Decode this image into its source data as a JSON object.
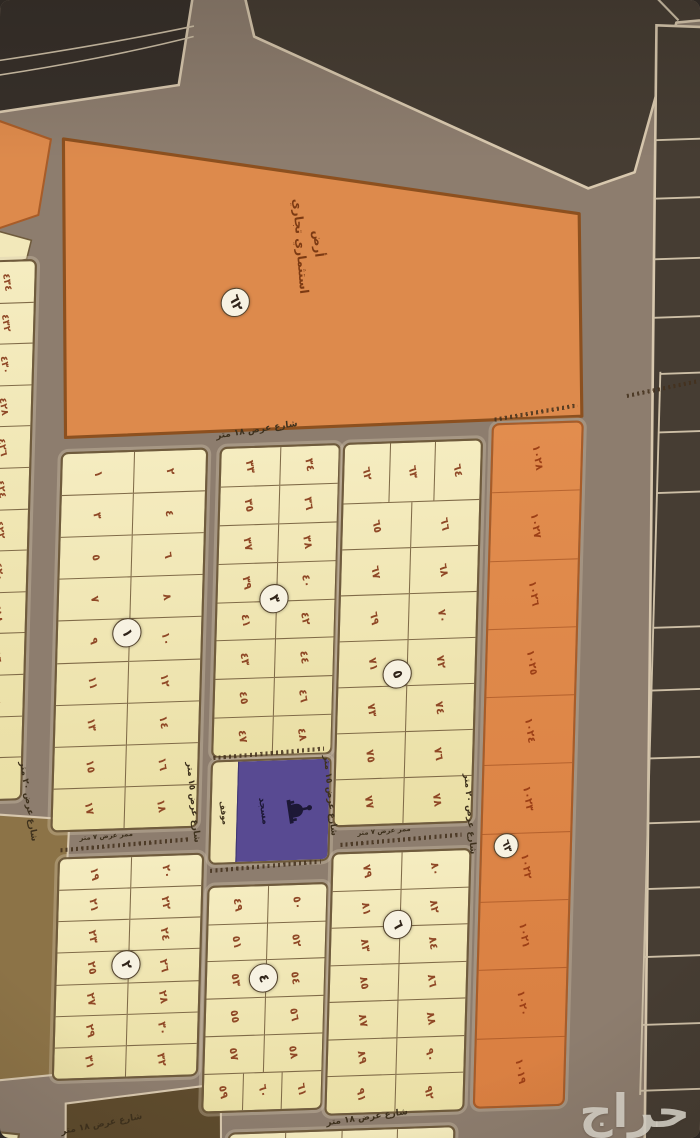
{
  "watermark": "حراج",
  "commercial": {
    "name_line1": "أرض",
    "name_line2": "استثماري تجاري",
    "circle": "٦٢"
  },
  "orange_strip": {
    "circle": "٦٣",
    "plots": [
      "١٠٢٨",
      "١٠٢٧",
      "١٠٢٦",
      "١٠٢٥",
      "١٠٢٤",
      "١٠٢٣",
      "١٠٢٢",
      "١٠٢١",
      "١٠٢٠",
      "١٠١٩"
    ]
  },
  "left_column": [
    "٤٣٤",
    "٤٣٢",
    "٤٣٠",
    "٤٢٨",
    "٤٢٦",
    "٤٢٤",
    "٤٢٢",
    "٤٢٠",
    "٤١٨",
    "٤١٦",
    "٤١٤",
    "٤١٢",
    "٤١٠"
  ],
  "blocks": {
    "b1": {
      "circle": "١",
      "left": [
        "١",
        "٣",
        "٥",
        "٧",
        "٩",
        "١١",
        "١٣",
        "١٥",
        "١٧"
      ],
      "right": [
        "٢",
        "٤",
        "٦",
        "٨",
        "١٠",
        "١٢",
        "١٤",
        "١٦",
        "١٨"
      ]
    },
    "b2": {
      "circle": "٢",
      "left": [
        "١٩",
        "٢١",
        "٢٣",
        "٢٥",
        "٢٧",
        "٢٩",
        "٣١"
      ],
      "right": [
        "٢٠",
        "٢٢",
        "٢٤",
        "٢٦",
        "٢٨",
        "٣٠",
        "٣٢"
      ]
    },
    "b3": {
      "circle": "٣",
      "left": [
        "٣٣",
        "٣٥",
        "٣٧",
        "٣٩",
        "٤١",
        "٤٣",
        "٤٥",
        "٤٧"
      ],
      "right": [
        "٣٤",
        "٣٦",
        "٣٨",
        "٤٠",
        "٤٢",
        "٤٤",
        "٤٦",
        "٤٨"
      ]
    },
    "b4": {
      "circle": "٤",
      "left": [
        "٤٩",
        "٥١",
        "٥٣",
        "٥٥",
        "٥٧"
      ],
      "right": [
        "٥٠",
        "٥٢",
        "٥٤",
        "٥٦",
        "٥٨"
      ],
      "bottom": [
        "٥٩",
        "٦٠",
        "٦١"
      ]
    },
    "b5": {
      "circle": "٥",
      "top": [
        "٦٢",
        "٦٣",
        "٦٤"
      ],
      "left": [
        "٦٥",
        "٦٧",
        "٦٩",
        "٧١",
        "٧٣",
        "٧٥",
        "٧٧"
      ],
      "right": [
        "٦٦",
        "٦٨",
        "٧٠",
        "٧٢",
        "٧٤",
        "٧٦",
        "٧٨"
      ]
    },
    "b6": {
      "circle": "٦",
      "left": [
        "٧٩",
        "٨١",
        "٨٣",
        "٨٥",
        "٨٧",
        "٨٩",
        "٩١"
      ],
      "right": [
        "٨٠",
        "٨٢",
        "٨٤",
        "٨٦",
        "٨٨",
        "٩٠",
        "٩٢"
      ]
    }
  },
  "bottom_row": [
    "٩٣",
    "٩٥",
    "٩٧",
    "٩٩"
  ],
  "mosque": {
    "label": "مسجد",
    "parking": "موقف"
  },
  "streets": {
    "s18_top": "شارع عرض ١٨ متر",
    "s20_left": "شارع عرض ٢٠ متر",
    "s15_left": "شارع عرض ١٥ متر",
    "s15_right": "شارع عرض ١٥ متر",
    "s20_right": "شارع عرض ٢٠ متر",
    "s18_bottom": "شارع عرض ١٨ متر",
    "s18_bottom_left": "شارع عرض ١٨ متر",
    "lane7_1": "ممر عرض ٧ متر",
    "lane7_2": "ممر عرض ٧ متر"
  },
  "colors": {
    "road": "#8d7d6e",
    "dark_area": "#463d33",
    "plot_cream": "#f2e8ba",
    "plot_orange": "#dd8a4c",
    "mosque_purple": "#584a92",
    "curb_light": "#d8c8ae",
    "number_brown": "#8f4826"
  }
}
